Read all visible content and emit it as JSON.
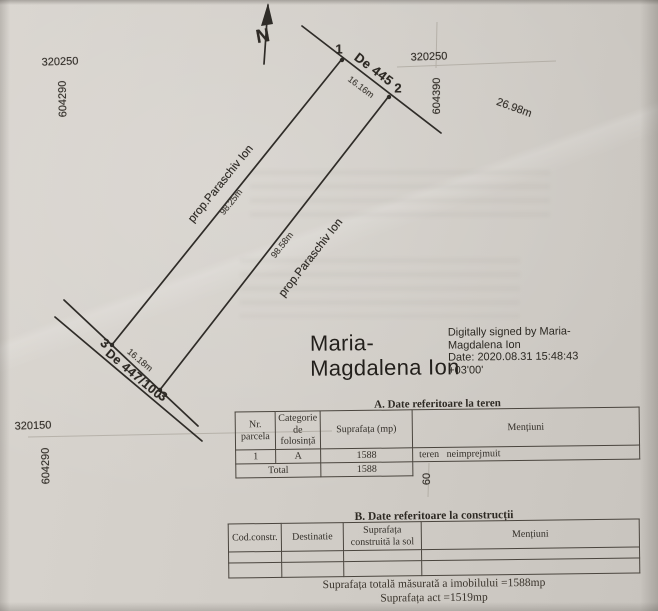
{
  "plan": {
    "north_label": "N",
    "grid": {
      "top_left_northing": "320250",
      "top_left_easting": "604290",
      "top_right_northing": "320250",
      "top_right_easting": "604390",
      "bottom_left_northing": "320150",
      "bottom_left_easting": "604290",
      "bottom_right_easting_partial": "60"
    },
    "points": {
      "p1": "1",
      "p2": "2",
      "p3a": "3",
      "p3b": "3"
    },
    "roads": {
      "top": "De 445",
      "bottom": "De 447/100"
    },
    "neighbor_left": "prop.Paraschiv Ion",
    "neighbor_right": "prop.Paraschiv Ion",
    "measurements": {
      "top_width": "16.16m",
      "road_extra": "26.98m",
      "left_length": "98.25m",
      "right_length": "98.58m",
      "bottom_width": "16.18m"
    }
  },
  "signature": {
    "name_line1": "Maria-",
    "name_line2": "Magdalena Ion",
    "detail_line1": "Digitally signed by Maria-",
    "detail_line2": "Magdalena Ion",
    "detail_line3": "Date: 2020.08.31 15:48:43",
    "detail_line4": "+03'00'"
  },
  "table_a": {
    "title": "A. Date referitoare la teren",
    "col_nr": "Nr. parcela",
    "col_cat": "Categorie de folosință",
    "col_sup": "Suprafața (mp)",
    "col_men": "Mențiuni",
    "row": {
      "nr": "1",
      "cat": "A",
      "sup": "1588",
      "men": "teren neimprejmuit"
    },
    "total_label": "Total",
    "total_value": "1588"
  },
  "table_b": {
    "title": "B. Date referitoare la construcții",
    "col_cod": "Cod.constr.",
    "col_dest": "Destinatie",
    "col_sup": "Suprafața construită la sol",
    "col_men": "Mențiuni"
  },
  "summary": {
    "line1": "Suprafața totală măsurată a imobilului =1588mp",
    "line2": "Suprafața act =1519mp"
  }
}
